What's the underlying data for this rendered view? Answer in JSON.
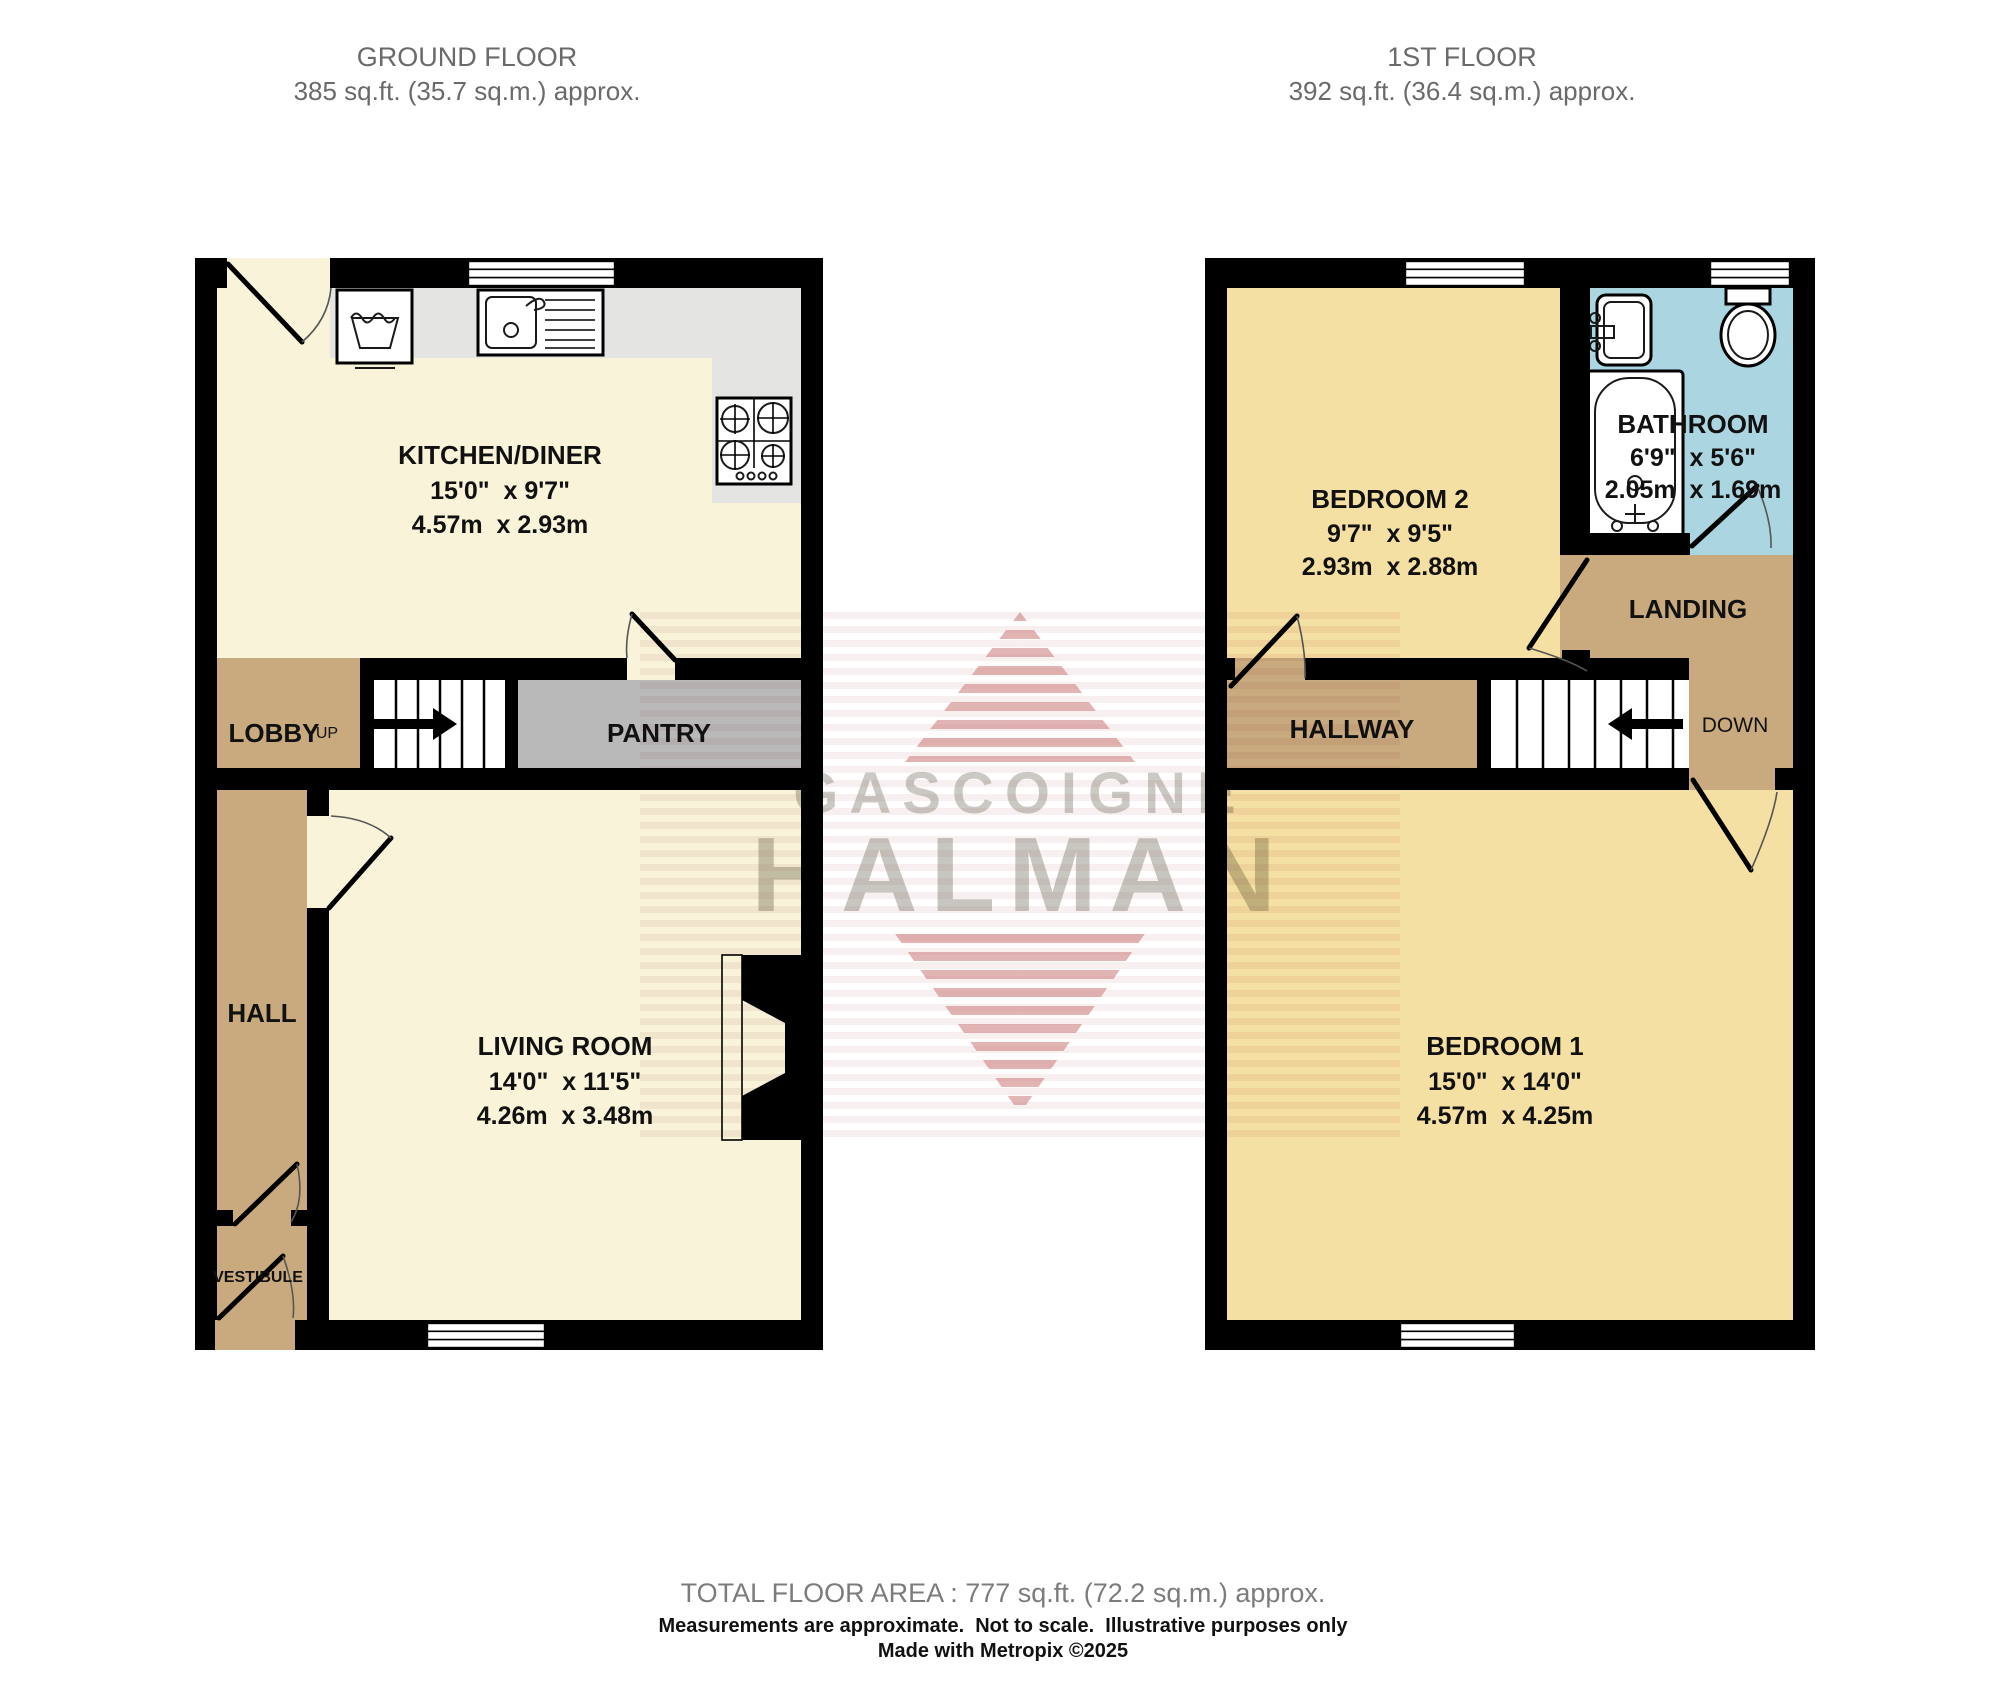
{
  "ground_floor": {
    "header": {
      "title": "GROUND FLOOR",
      "area": "385 sq.ft. (35.7 sq.m.) approx."
    },
    "rooms": {
      "kitchen": {
        "name": "KITCHEN/DINER",
        "dim_imperial": "15'0\"  x 9'7\"",
        "dim_metric": "4.57m  x 2.93m"
      },
      "lobby": {
        "name": "LOBBY"
      },
      "pantry": {
        "name": "PANTRY"
      },
      "hall": {
        "name": "HALL"
      },
      "living": {
        "name": "LIVING ROOM",
        "dim_imperial": "14'0\"  x 11'5\"",
        "dim_metric": "4.26m  x 3.48m"
      },
      "vestibule": {
        "name": "VESTIBULE"
      }
    },
    "stairs": {
      "label": "UP"
    }
  },
  "first_floor": {
    "header": {
      "title": "1ST FLOOR",
      "area": "392 sq.ft. (36.4 sq.m.) approx."
    },
    "rooms": {
      "bedroom2": {
        "name": "BEDROOM 2",
        "dim_imperial": "9'7\"  x 9'5\"",
        "dim_metric": "2.93m  x 2.88m"
      },
      "bathroom": {
        "name": "BATHROOM",
        "dim_imperial": "6'9\"  x 5'6\"",
        "dim_metric": "2.05m  x 1.69m"
      },
      "landing": {
        "name": "LANDING"
      },
      "hallway": {
        "name": "HALLWAY"
      },
      "bedroom1": {
        "name": "BEDROOM 1",
        "dim_imperial": "15'0\"  x 14'0\"",
        "dim_metric": "4.57m  x 4.25m"
      }
    },
    "stairs": {
      "label": "DOWN"
    }
  },
  "watermark": {
    "line1": "GASCOIGNE",
    "line2": "HALMAN"
  },
  "footer": {
    "total_area": "TOTAL FLOOR AREA : 777 sq.ft. (72.2 sq.m.) approx.",
    "disclaimer": "Measurements are approximate.  Not to scale.  Illustrative purposes only",
    "credit": "Made with Metropix ©2025"
  },
  "colors": {
    "wall": "#000000",
    "floor_cream": "#f8f3d9",
    "floor_yellow": "#f5e0a3",
    "floor_tan": "#c9aa7e",
    "pantry_gray": "#b9b9b9",
    "counter_gray": "#e4e4e2",
    "bathroom_blue": "#abd5e1",
    "watermark_red": "#c66c6c",
    "header_gray": "#6a6a6a"
  }
}
